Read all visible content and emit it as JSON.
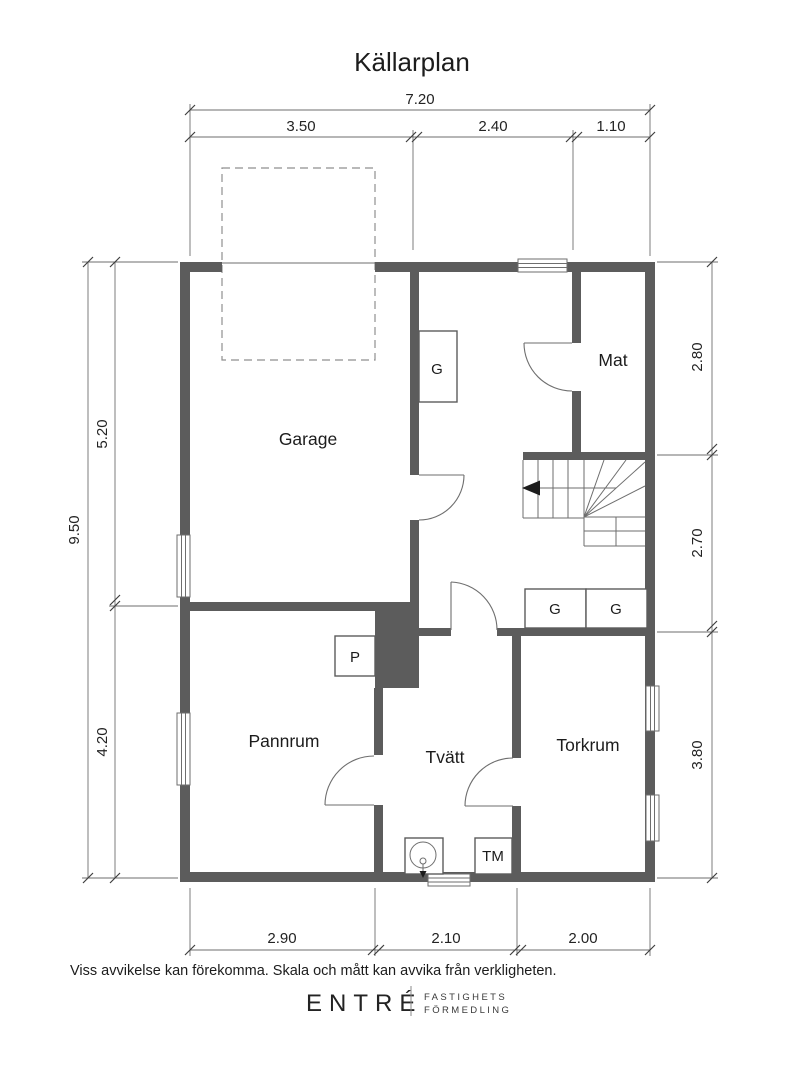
{
  "title": "Källarplan",
  "colors": {
    "wall": "#5c5c5c",
    "line": "#6e6e6e",
    "dimline": "#6e6e6e",
    "text": "#1c1c1c",
    "background": "#ffffff"
  },
  "rooms": {
    "garage": "Garage",
    "mat": "Mat",
    "pannrum": "Pannrum",
    "tvatt": "Tvätt",
    "torkrum": "Torkrum"
  },
  "fixtures": {
    "closet_garage": "G",
    "boiler": "P",
    "closet_hall_1": "G",
    "closet_hall_2": "G",
    "washing_machine": "TM"
  },
  "dimensions": {
    "top_total": "7.20",
    "top_segments": [
      "3.50",
      "2.40",
      "1.10"
    ],
    "left_total": "9.50",
    "left_segments": [
      "5.20",
      "4.20"
    ],
    "right_segments": [
      "2.80",
      "2.70",
      "3.80"
    ],
    "bottom_segments": [
      "2.90",
      "2.10",
      "2.00"
    ]
  },
  "footer": {
    "disclaimer": "Viss avvikelse kan förekomma. Skala och mått kan avvika från verkligheten."
  },
  "logo": {
    "brand": "ENTRÉ",
    "tagline_line1": "FASTIGHETS",
    "tagline_line2": "FÖRMEDLING"
  }
}
